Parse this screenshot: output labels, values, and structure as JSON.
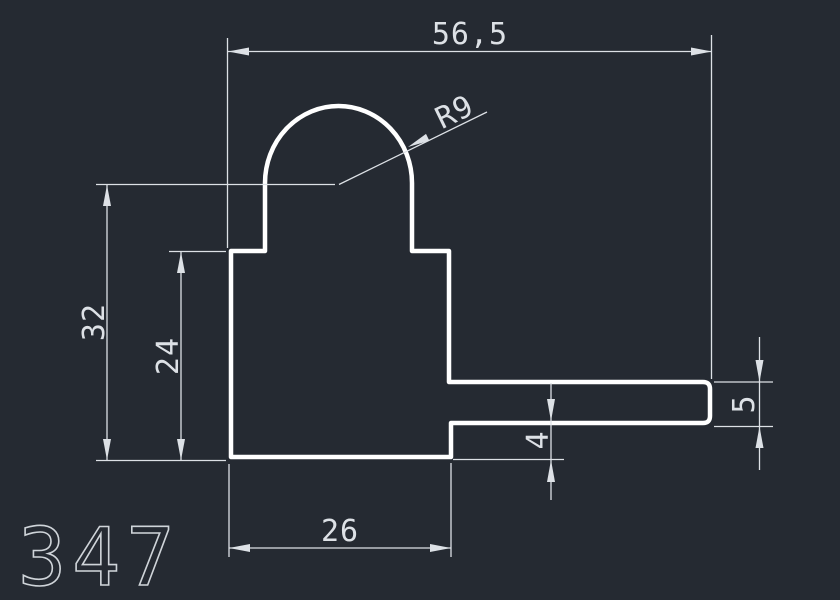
{
  "canvas": {
    "background": "#252a32",
    "profile_color": "#ffffff",
    "dim_color": "#dde1e6",
    "part_label_color": "#cfd4d9"
  },
  "part_label": "347",
  "dimensions": {
    "overall_width": "56,5",
    "arc_radius": "R9",
    "overall_height": "32",
    "body_height": "24",
    "body_width": "26",
    "flange_bottom_offset": "4",
    "flange_thickness": "5"
  }
}
